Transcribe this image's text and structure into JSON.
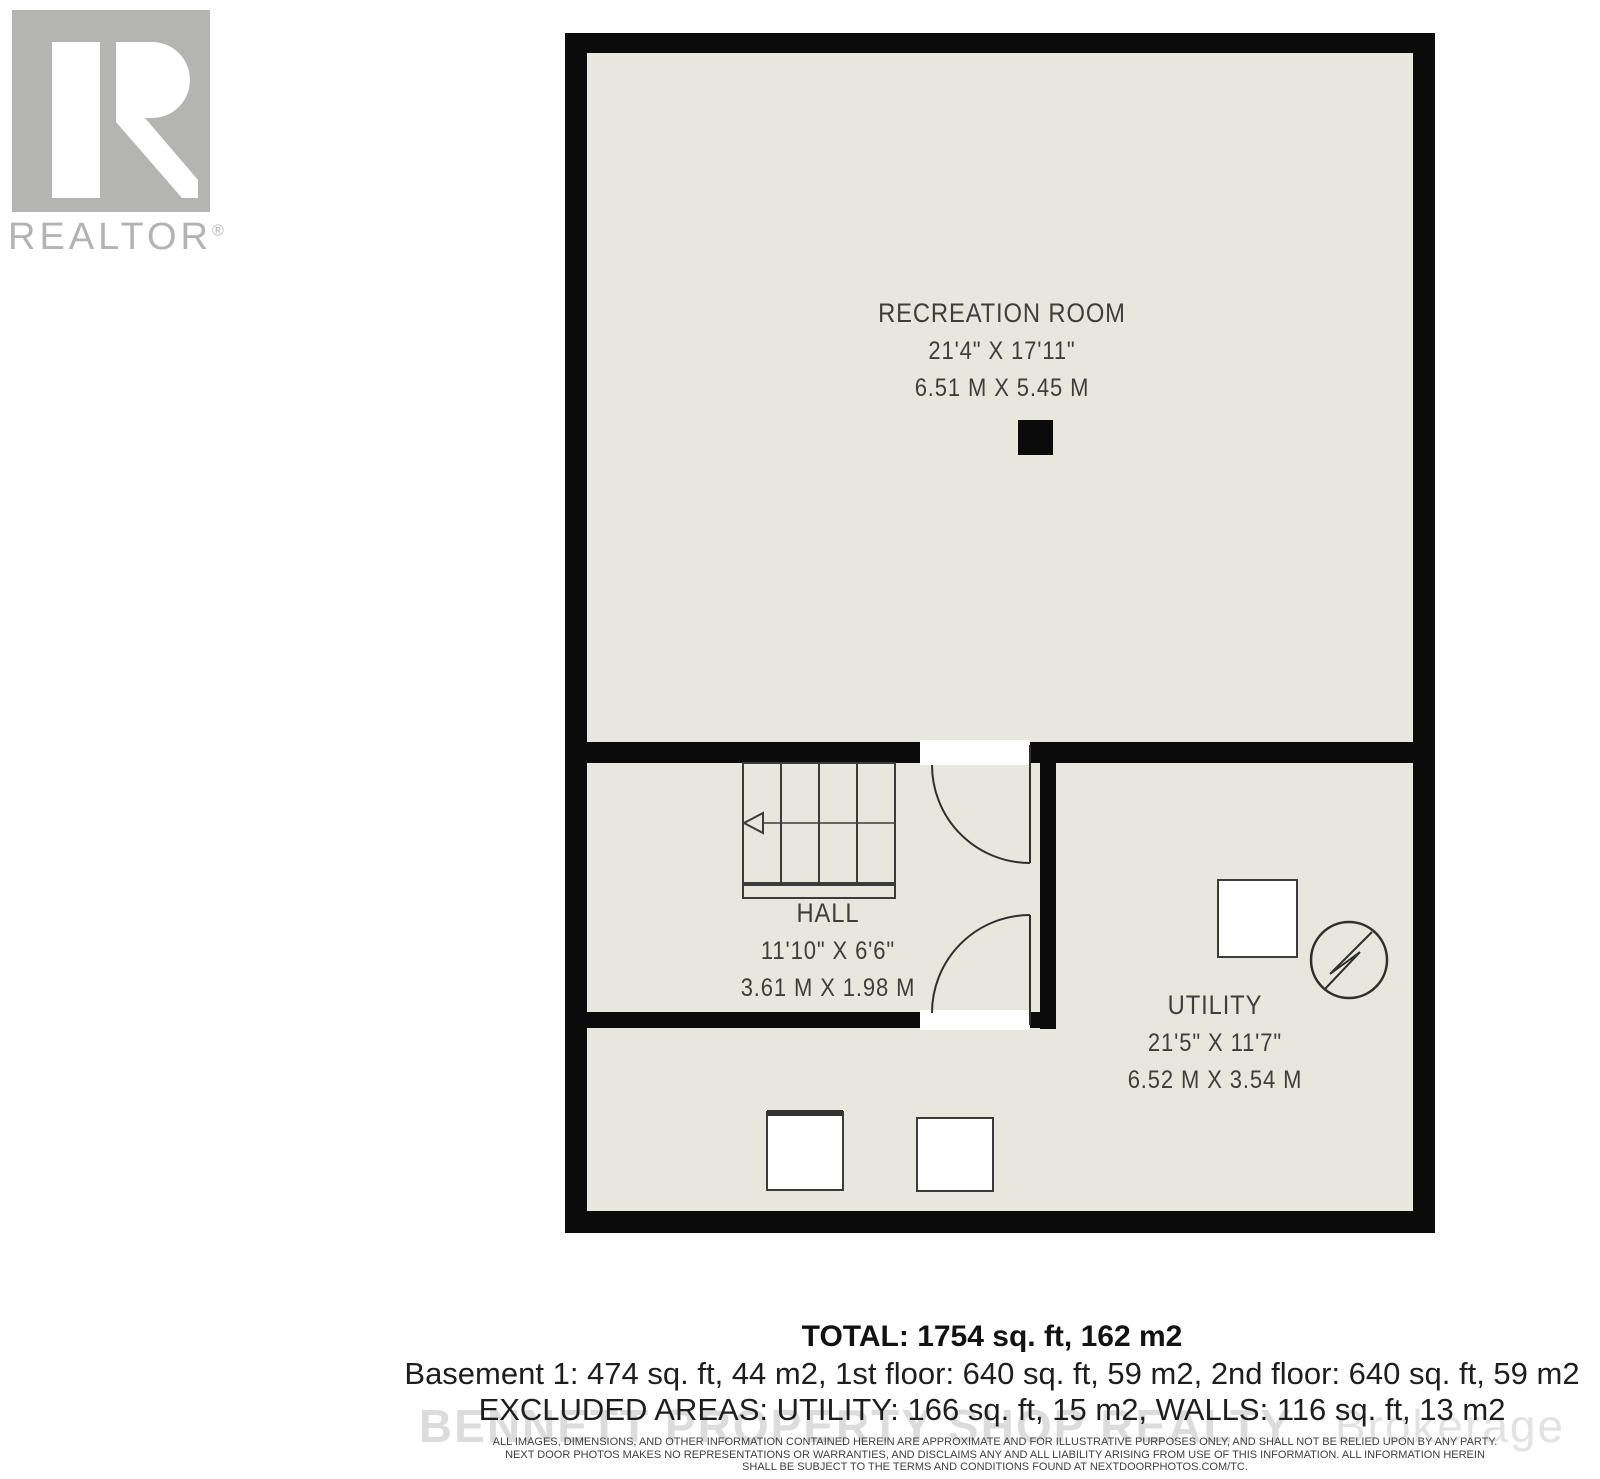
{
  "logo": {
    "brand": "REALTOR",
    "registered": "®"
  },
  "floorplan": {
    "rooms": [
      {
        "id": "recreation-room",
        "name": "RECREATION ROOM",
        "dimensions_imperial": "21'4\" X 17'11\"",
        "dimensions_metric": "6.51 M X 5.45 M"
      },
      {
        "id": "hall",
        "name": "HALL",
        "dimensions_imperial": "11'10\" X 6'6\"",
        "dimensions_metric": "3.61 M X 1.98 M"
      },
      {
        "id": "utility",
        "name": "UTILITY",
        "dimensions_imperial": "21'5\" X 11'7\"",
        "dimensions_metric": "6.52 M X 3.54 M"
      }
    ],
    "symbols": [
      "staircase",
      "door-swing-upper",
      "door-swing-lower",
      "support-column",
      "utility-box",
      "electrical-meter",
      "appliance-left",
      "appliance-right"
    ],
    "colors": {
      "wall": "#0b0b0b",
      "floor": "#e8e7de",
      "line": "#3b3b3b"
    }
  },
  "summary": {
    "total": "TOTAL: 1754 sq. ft, 162 m2",
    "floors": "Basement 1: 474 sq. ft, 44 m2, 1st floor: 640 sq. ft, 59 m2, 2nd floor: 640 sq. ft, 59 m2",
    "excluded": "EXCLUDED AREAS: UTILITY: 166 sq. ft, 15 m2, WALLS: 116 sq. ft, 13 m2"
  },
  "watermark": {
    "main": "BENNETT PROPERTY SHOP REALTY",
    "suffix": "Brokerage"
  },
  "disclaimer": {
    "line1": "ALL IMAGES, DIMENSIONS, AND OTHER INFORMATION CONTAINED HEREIN ARE APPROXIMATE AND FOR ILLUSTRATIVE PURPOSES ONLY, AND SHALL NOT BE RELIED UPON BY ANY PARTY.",
    "line2": "NEXT DOOR PHOTOS MAKES NO REPRESENTATIONS OR WARRANTIES, AND DISCLAIMS ANY AND ALL LIABILITY ARISING FROM USE OF THIS INFORMATION. ALL INFORMATION HEREIN",
    "line3": "SHALL BE SUBJECT TO THE TERMS AND CONDITIONS FOUND AT NEXTDOORPHOTOS.COM/TC."
  }
}
